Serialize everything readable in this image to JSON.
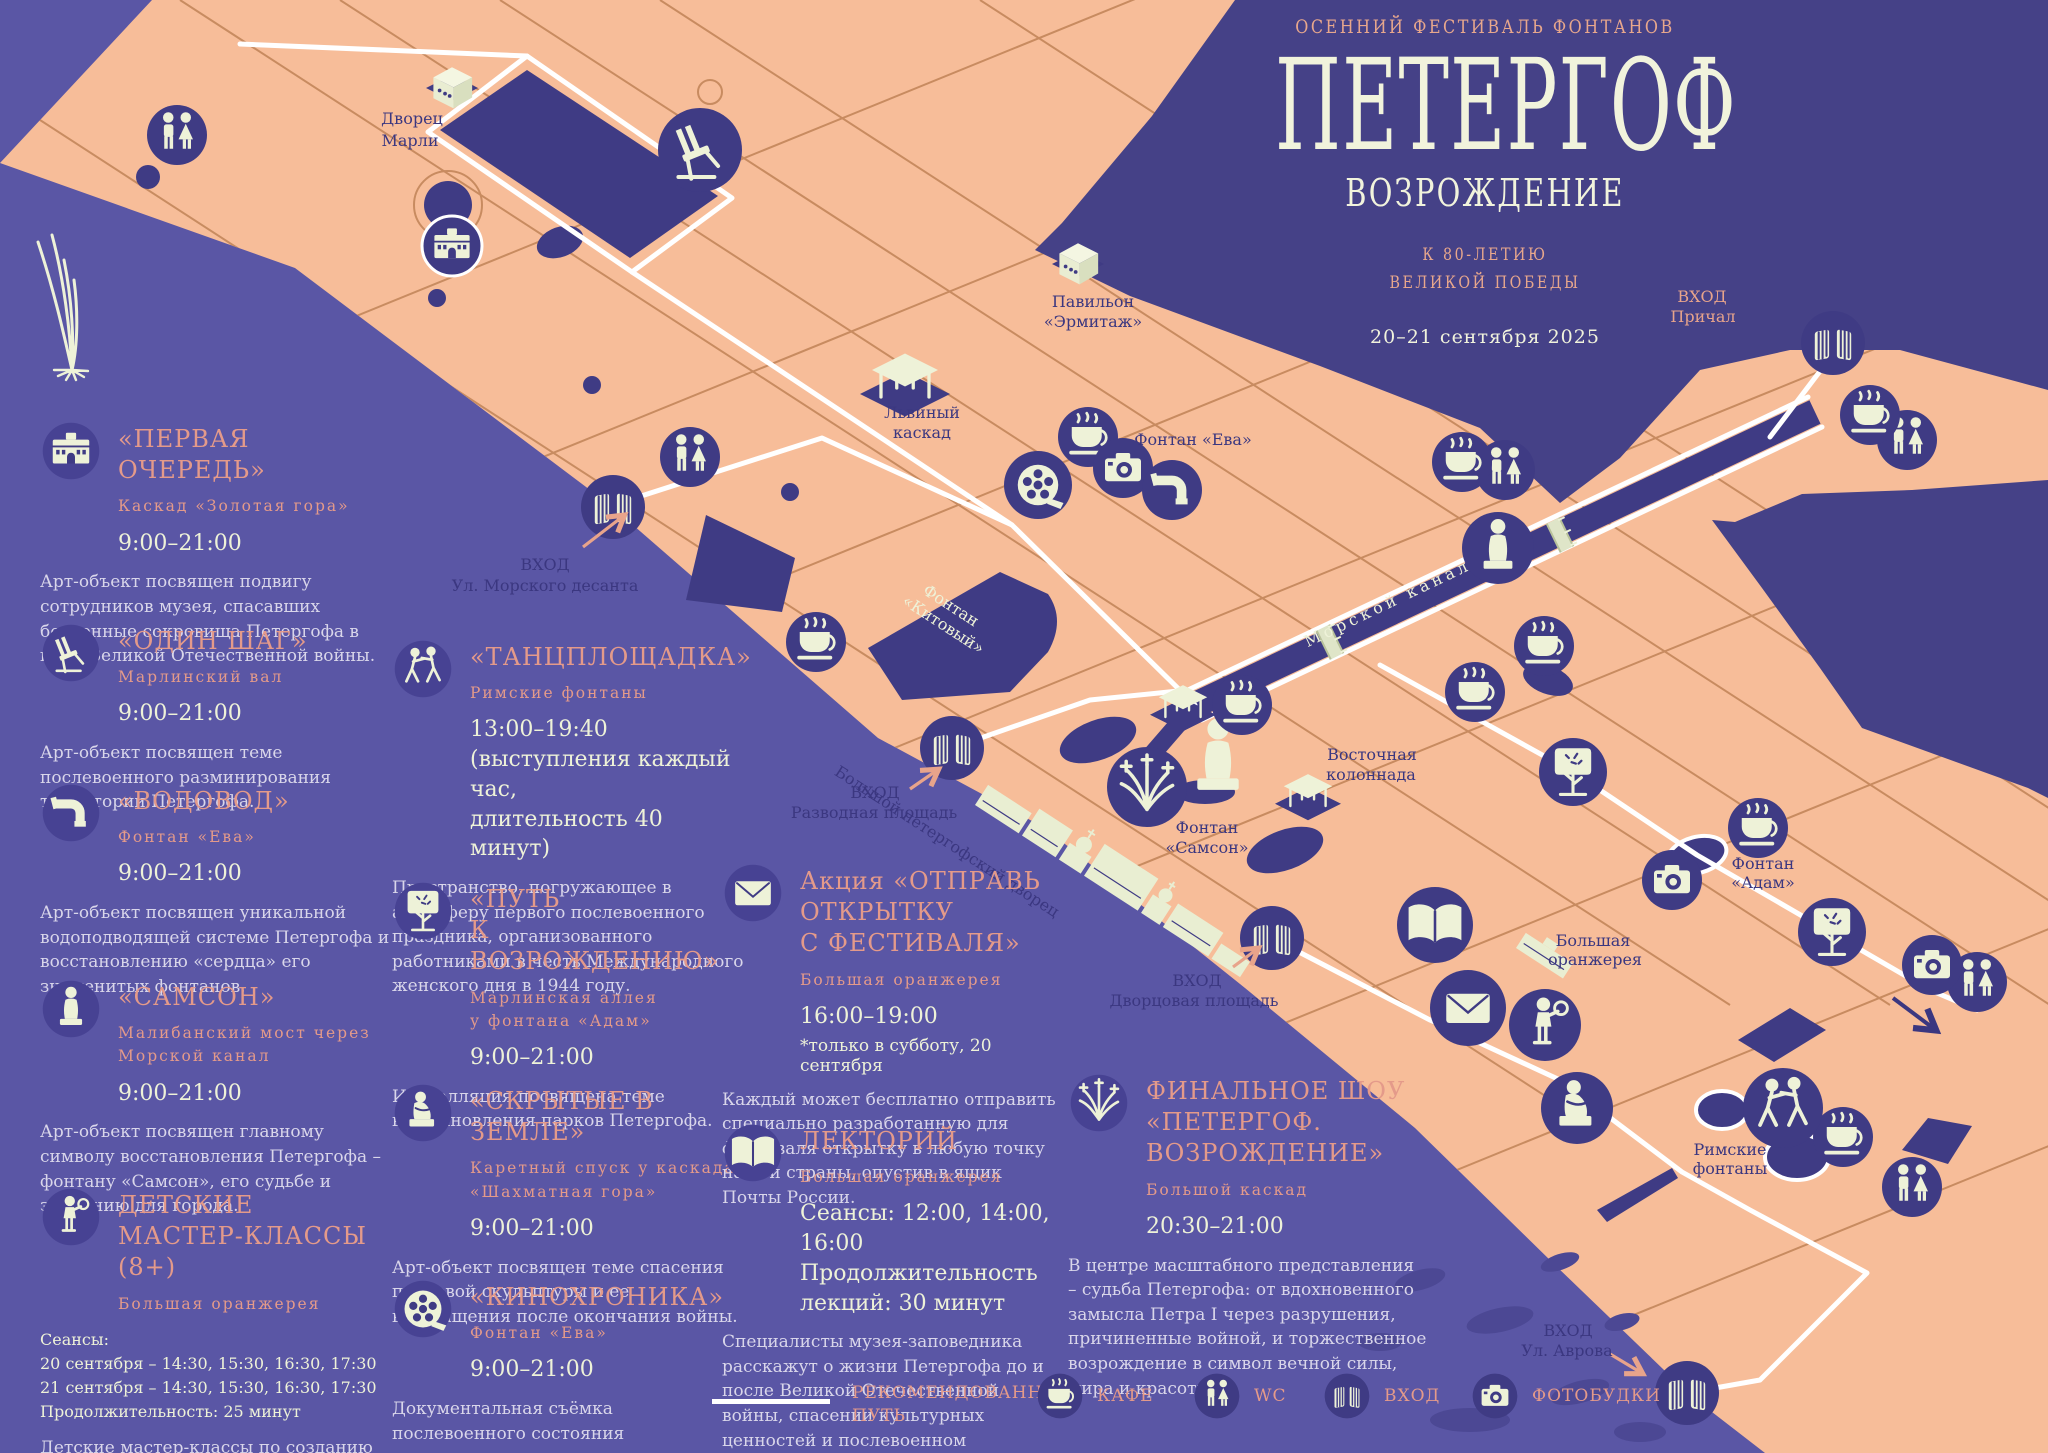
{
  "poster": {
    "festival_label": "ОСЕННИЙ ФЕСТИВАЛЬ ФОНТАНОВ",
    "title": "ПЕТЕРГОФ",
    "subtitle": "ВОЗРОЖДЕНИЕ",
    "dedication": "К 80-ЛЕТИЮ\nВЕЛИКОЙ ПОБЕДЫ",
    "dates": "20–21 сентября 2025"
  },
  "events": [
    {
      "icon": "palace-icon",
      "title": "«ПЕРВАЯ ОЧЕРЕДЬ»",
      "location": "Каскад «Золотая гора»",
      "time": "9:00–21:00",
      "description": "Арт-объект посвящен подвигу сотрудников музея, спасавших бесценные сокровища Петергофа в годы Великой Отечественной войны."
    },
    {
      "icon": "chair-icon",
      "title": "«ОДИН ШАГ»",
      "location": "Марлинский вал",
      "time": "9:00–21:00",
      "description": "Арт-объект посвящен теме послевоенного разминирования территории Петергофа."
    },
    {
      "icon": "pipe-icon",
      "title": "«ВОДОВОД»",
      "location": "Фонтан «Ева»",
      "time": "9:00–21:00",
      "description": "Арт-объект посвящен уникальной водоподводящей системе Петергофа и восстановлению «сердца» его знаменитых фонтанов."
    },
    {
      "icon": "statue-icon",
      "title": "«САМСОН»",
      "location": "Малибанский мост через\nМорской канал",
      "time": "9:00–21:00",
      "description": "Арт-объект посвящен главному символу восстановления Петергофа – фонтану «Самсон», его судьбе и значению для города."
    },
    {
      "icon": "child-icon",
      "title": "ДЕТСКИЕ\nМАСТЕР-КЛАССЫ (8+)",
      "location": "Большая оранжерея",
      "schedule": "Сеансы:\n20 сентября – 14:30, 15:30, 16:30, 17:30\n21 сентября – 14:30, 15:30, 16:30, 17:30\nПродолжительность: 25 минут",
      "description": "Детские мастер-классы по созданию фигурок-символов возрождения Петергофа."
    },
    {
      "icon": "dancers-icon",
      "title": "«ТАНЦПЛОЩАДКА»",
      "location": "Римские фонтаны",
      "time": "13:00–19:40\n(выступления каждый час,\nдлительность 40 минут)",
      "description": "Пространство, погружающее в атмосферу первого послевоенного праздника, организованного работниками в честь Международного женского дня в 1944 году."
    },
    {
      "icon": "tree-icon",
      "title": "«ПУТЬ\nК ВОЗРОЖДЕНИЮ»",
      "location": "Марлинская аллея\nу фонтана «Адам»",
      "time": "9:00–21:00",
      "description": "Инсталляция посвящена теме восстановления парков Петергофа."
    },
    {
      "icon": "seated-statue-icon",
      "title": "«СКРЫТЫЕ В ЗЕМЛЕ»",
      "location": "Каретный спуск у каскада\n«Шахматная гора»",
      "time": "9:00–21:00",
      "description": "Арт-объект посвящен теме спасения парковой скульптуры и ее возвращения после окончания войны."
    },
    {
      "icon": "film-reel-icon",
      "title": "«КИНОХРОНИКА»",
      "location": "Фонтан «Ева»",
      "time": "9:00–21:00",
      "description": "Документальная съёмка послевоенного состояния архитектурных памятников Петергофа."
    },
    {
      "icon": "envelope-icon",
      "title": "Акция «ОТПРАВЬ\nОТКРЫТКУ\nС ФЕСТИВАЛЯ»",
      "location": "Большая оранжерея",
      "time": "16:00–19:00",
      "note": "*только в субботу, 20 сентября",
      "description": "Каждый может бесплатно отправить специально разработанную для фестиваля открытку в любую точку нашей страны, опустив в ящик Почты России."
    },
    {
      "icon": "open-book-icon",
      "title": "ЛЕКТОРИЙ",
      "location": "Большая оранжерея",
      "time": "Сеансы: 12:00, 14:00, 16:00\nПродолжительность\nлекций: 30 минут",
      "description": "Специалисты музея-заповедника расскажут о жизни Петергофа до и после Великой Отечественной войны, спасении культурных ценностей и послевоенном восстановлении."
    },
    {
      "icon": "fireworks-icon",
      "title": "ФИНАЛЬНОЕ ШОУ\n«ПЕТЕРГОФ.\nВОЗРОЖДЕНИЕ»",
      "location": "Большой каскад",
      "time": "20:30–21:00",
      "description": "В центре масштабного представления – судьба Петергофа: от вдохновенного замысла Петра I через разрушения, причиненные войной, и торжественное возрождение в символ вечной силы, мира и красоты."
    }
  ],
  "legend": {
    "route": "РЕКОМЕНДОВАННЫЙ\nПУТЬ",
    "cafe": "КАФЕ",
    "wc": "WC",
    "entrance": "ВХОД",
    "photobooth": "ФОТОБУДКИ"
  },
  "map": {
    "marly1": "Дворец",
    "marly2": "Марли",
    "hermitage1": "Павильон",
    "hermitage2": "«Эрмитаж»",
    "lion1": "Львиный",
    "lion2": "каскад",
    "eva": "Фонтан «Ева»",
    "kit1": "Фонтан",
    "kit2": "«Китовый»",
    "canal": "Морской канал",
    "grand_palace": "Большой петергофский дворец",
    "samson1": "Фонтан",
    "samson2": "«Самсон»",
    "colonnade1": "Восточная",
    "colonnade2": "колоннада",
    "orangery1": "Большая",
    "orangery2": "оранжерея",
    "adam1": "Фонтан",
    "adam2": "«Адам»",
    "roman1": "Римские",
    "roman2": "фонтаны",
    "entr_desant1": "ВХОД",
    "entr_desant2": "Ул. Морского десанта",
    "entr_razvod1": "ВХОД",
    "entr_razvod2": "Разводная площадь",
    "entr_dvorts1": "ВХОД",
    "entr_dvorts2": "Дворцовая площадь",
    "entr_avrova1": "ВХОД",
    "entr_avrova2": "Ул. Аврова",
    "entr_prichal1": "ВХОД",
    "entr_prichal2": "Причал"
  },
  "colors": {
    "background_purple": "#5a56a5",
    "gulf_water": "#454187",
    "land_salmon": "#f7bd99",
    "pond_navy": "#3f3b84",
    "accent_salmon": "#e49a8a",
    "cream": "#eef2d8",
    "label_navy": "#3b3780",
    "route_white": "#ffffff",
    "path_brown": "#c6895e"
  }
}
